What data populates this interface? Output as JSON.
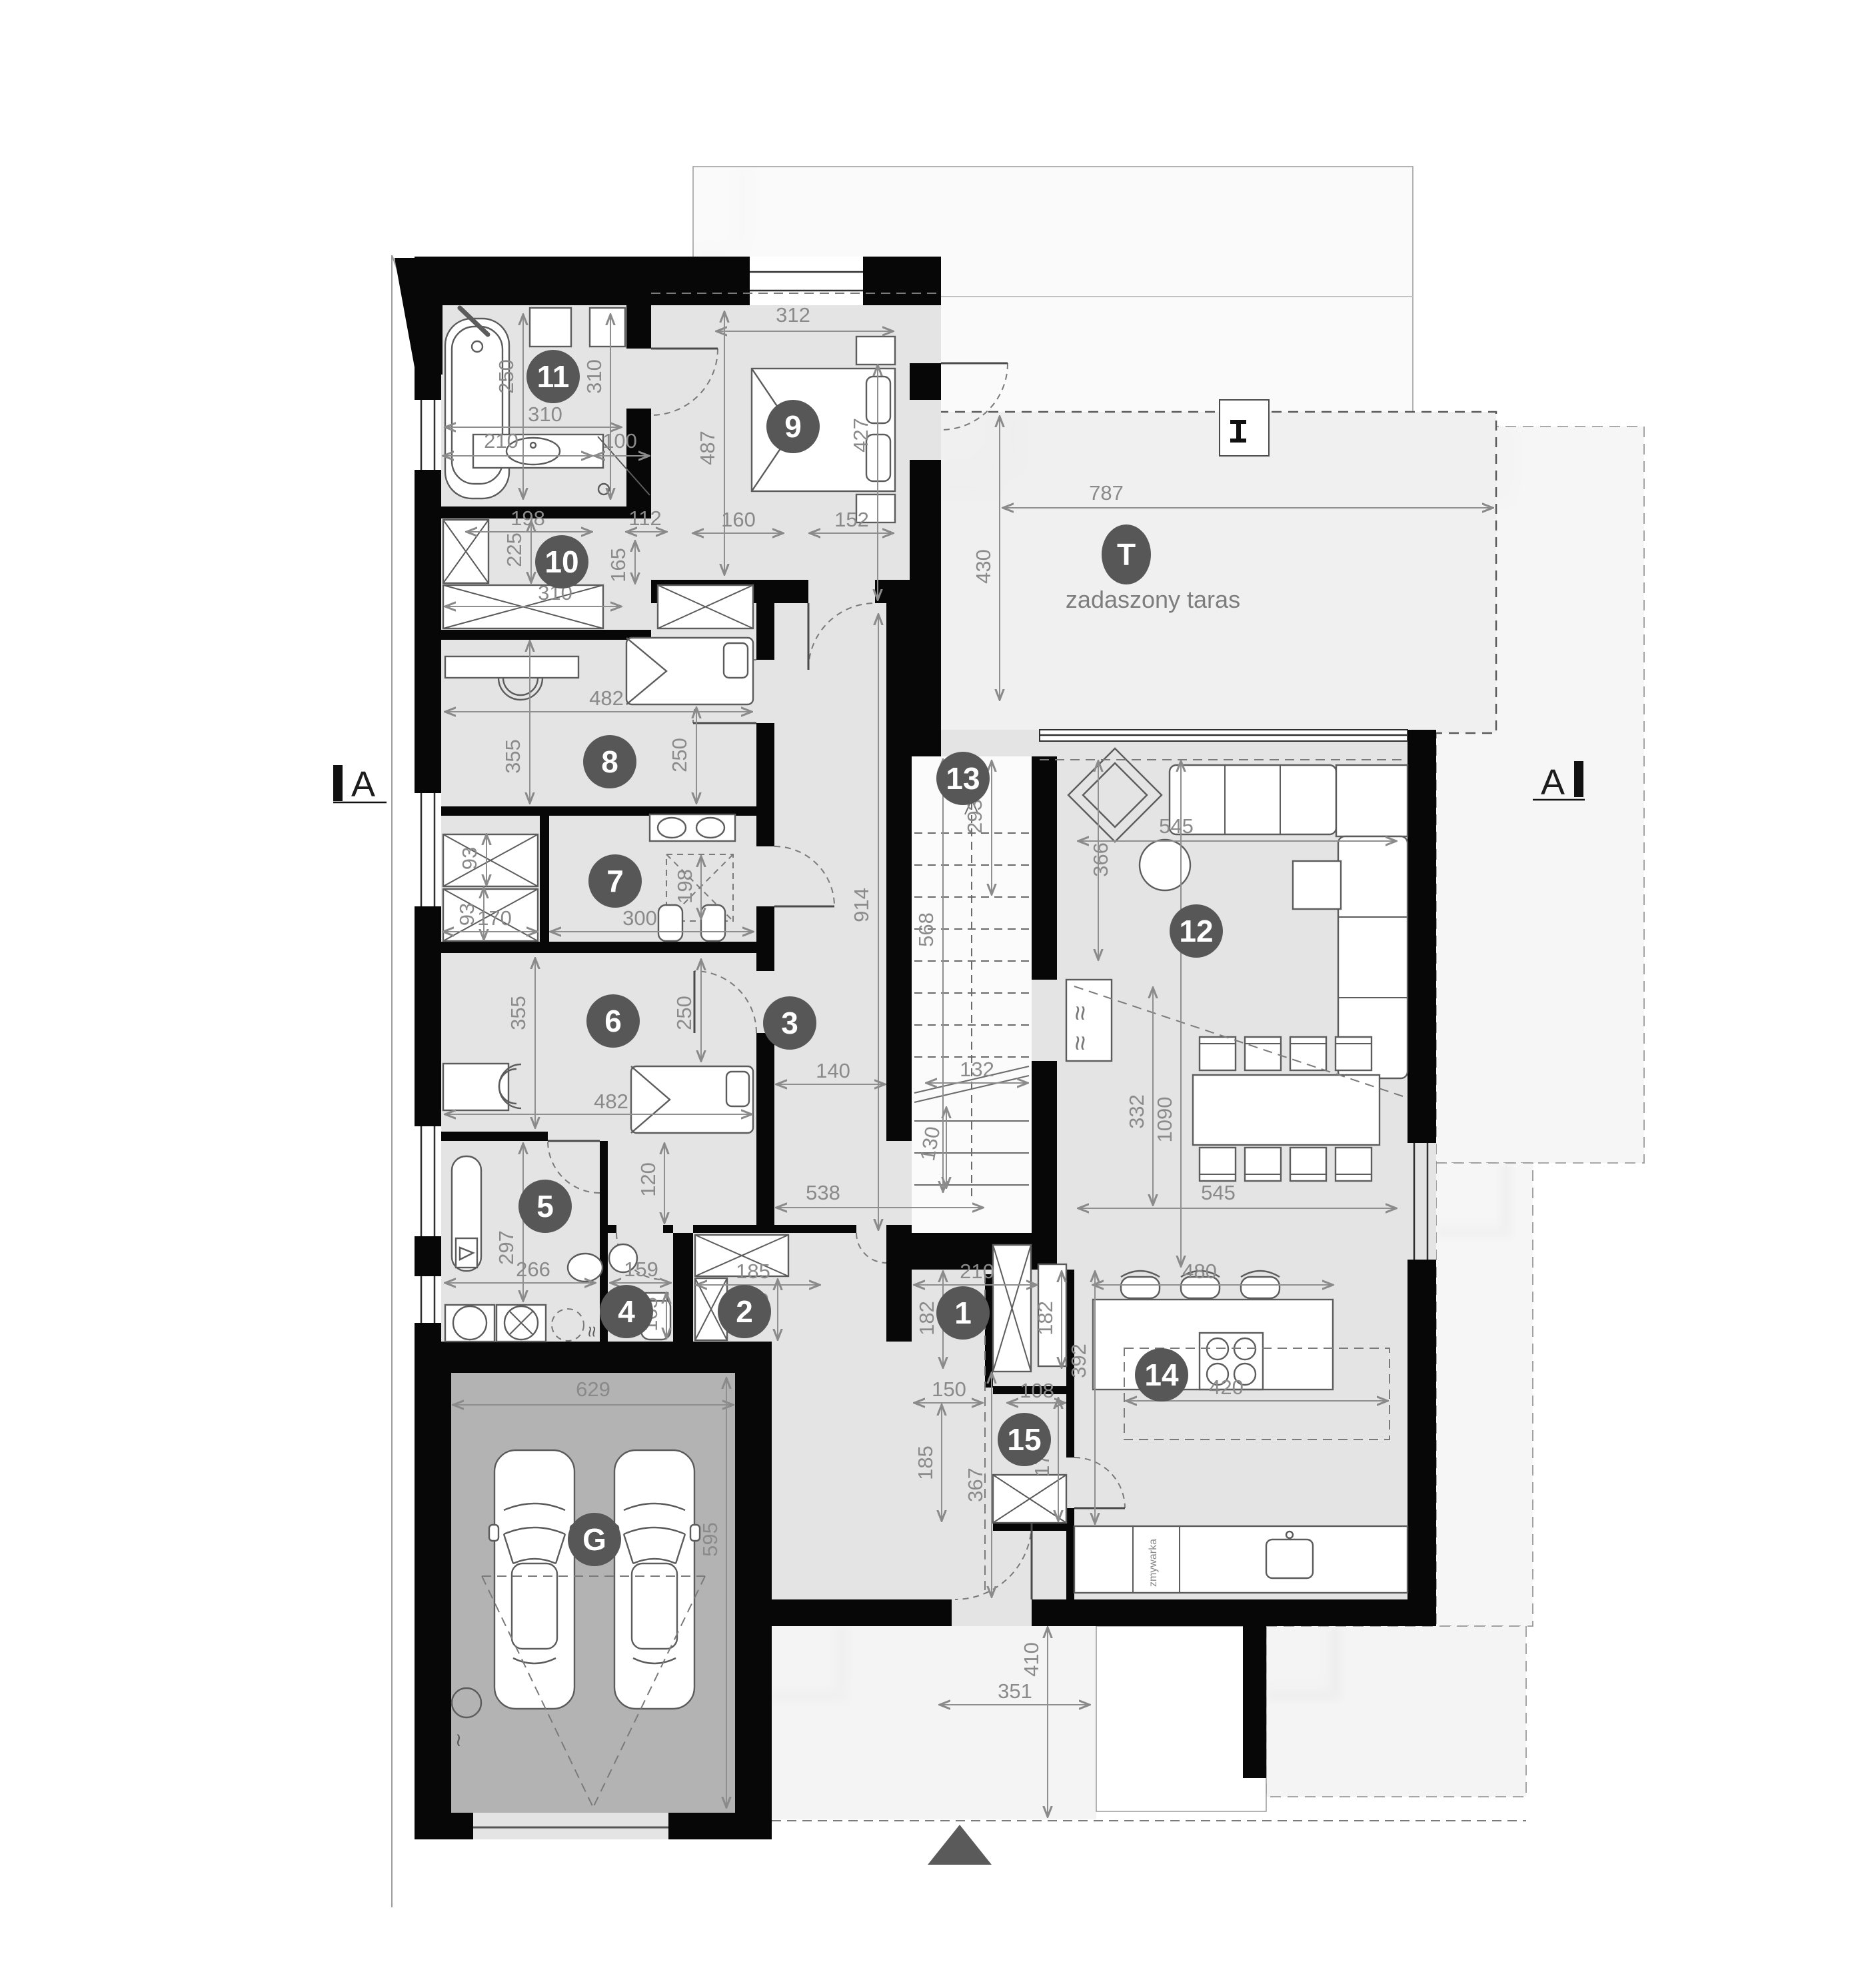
{
  "plan": {
    "terrace_label": "zadaszony taras",
    "dishwasher_label": "zmywarka",
    "section_label": "A"
  },
  "rooms": [
    "1",
    "2",
    "3",
    "4",
    "5",
    "6",
    "7",
    "8",
    "9",
    "10",
    "11",
    "12",
    "13",
    "14",
    "15",
    "G",
    "T"
  ],
  "dims": [
    "312",
    "487",
    "427",
    "160",
    "152",
    "430",
    "787",
    "250",
    "310",
    "310",
    "210",
    "100",
    "198",
    "225",
    "310",
    "112",
    "165",
    "482",
    "355",
    "250",
    "93",
    "93",
    "170",
    "300",
    "198",
    "914",
    "568",
    "293",
    "355",
    "482",
    "250",
    "140",
    "132",
    "130",
    "538",
    "545",
    "366",
    "545",
    "332",
    "1090",
    "480",
    "420",
    "392",
    "120",
    "297",
    "266",
    "159",
    "165",
    "185",
    "165",
    "210",
    "182",
    "182",
    "367",
    "150",
    "108",
    "185",
    "173",
    "629",
    "595",
    "351",
    "410"
  ]
}
